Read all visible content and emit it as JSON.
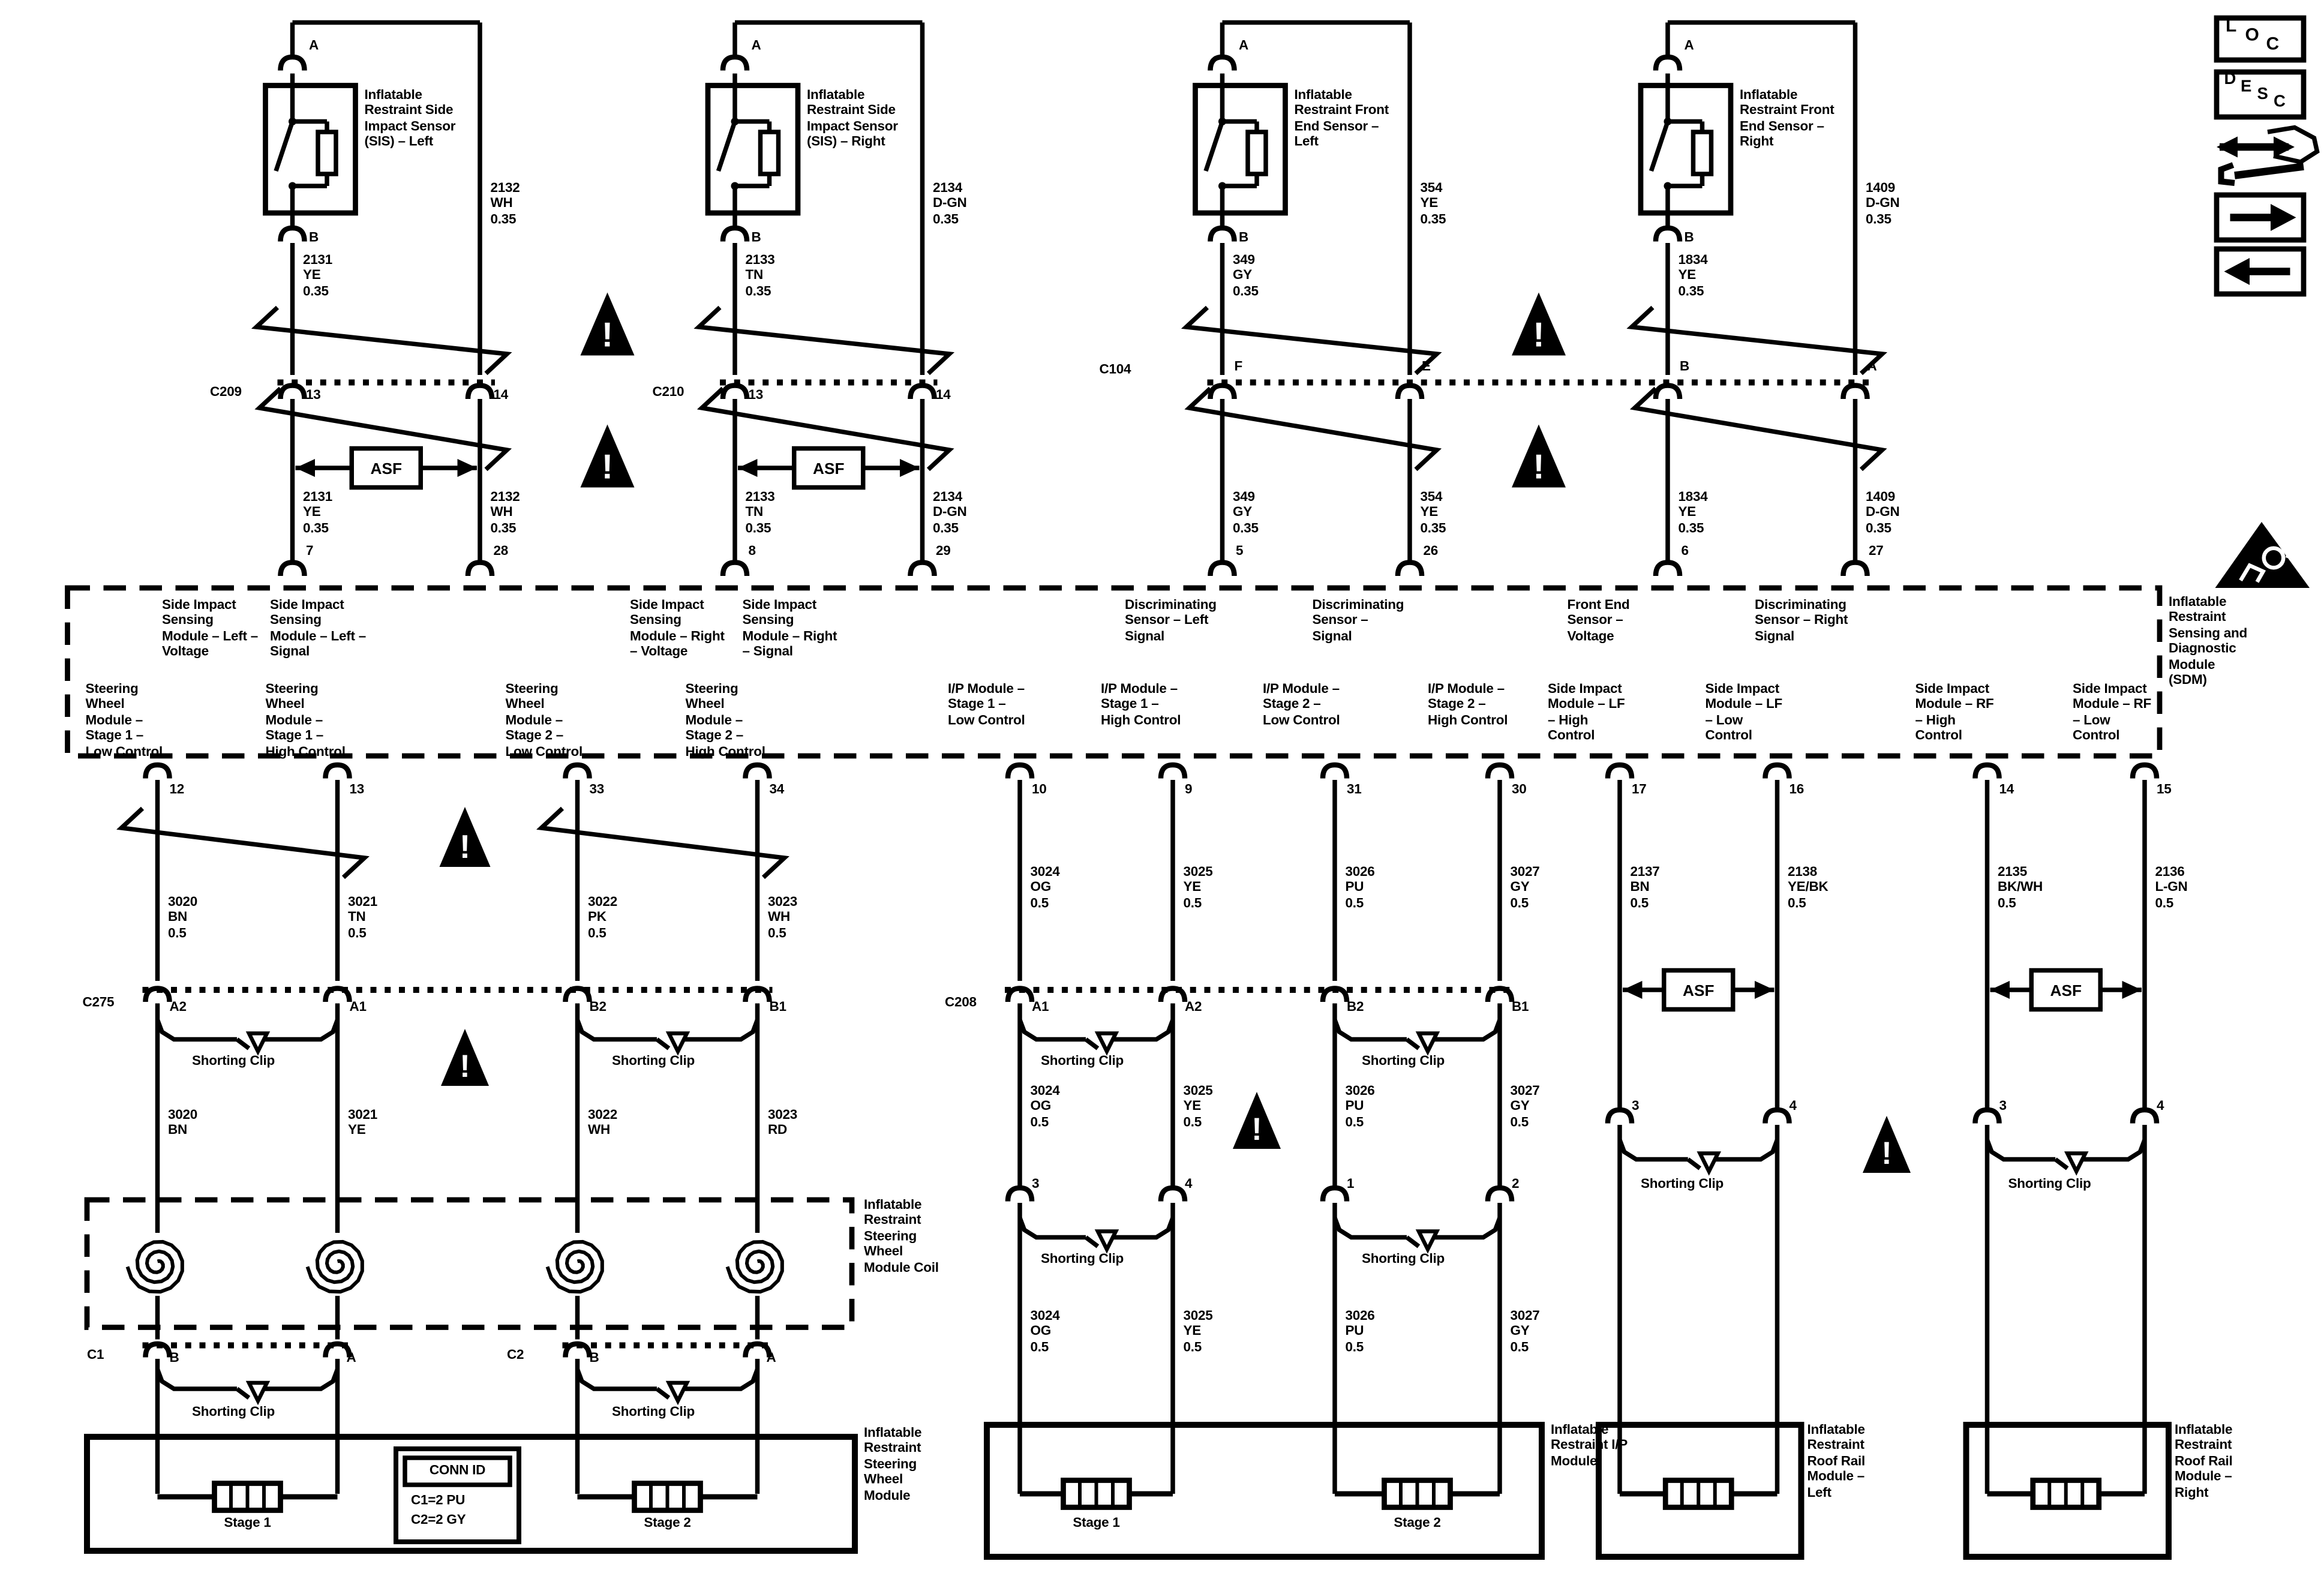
{
  "colors": {
    "ink": "#000000",
    "paper": "#ffffff"
  },
  "labels": {
    "shorting_clip": "Shorting Clip",
    "asf": "ASF",
    "warning_glyph": "!"
  },
  "legend": {
    "loc": "LOC",
    "desc": "DESC",
    "icons": [
      "loc-tag",
      "desc-tag",
      "wrench-direction",
      "arrow-right",
      "arrow-left",
      "sir-airbag-warning"
    ]
  },
  "sensor_circuits": [
    {
      "name": "Inflatable Restraint Side Impact Sensor (SIS) – Left",
      "top_pin": "A",
      "bottom_pin": "B",
      "left_wire": {
        "id": "2131",
        "color": "YE",
        "size": "0.35"
      },
      "right_wire": {
        "id": "2132",
        "color": "WH",
        "size": "0.35"
      },
      "connector": "C209",
      "conn_pin_left": "13",
      "conn_pin_right": "14",
      "sdm_pin_left": "7",
      "sdm_pin_right": "28"
    },
    {
      "name": "Inflatable Restraint Side Impact Sensor (SIS) – Right",
      "top_pin": "A",
      "bottom_pin": "B",
      "left_wire": {
        "id": "2133",
        "color": "TN",
        "size": "0.35"
      },
      "right_wire": {
        "id": "2134",
        "color": "D-GN",
        "size": "0.35"
      },
      "connector": "C210",
      "conn_pin_left": "13",
      "conn_pin_right": "14",
      "sdm_pin_left": "8",
      "sdm_pin_right": "29"
    },
    {
      "name": "Inflatable Restraint Front End Sensor – Left",
      "top_pin": "A",
      "bottom_pin": "B",
      "left_wire": {
        "id": "349",
        "color": "GY",
        "size": "0.35"
      },
      "right_wire": {
        "id": "354",
        "color": "YE",
        "size": "0.35"
      },
      "connector": "C104",
      "conn_pin_left": "F",
      "conn_pin_right": "E",
      "sdm_pin_left": "5",
      "sdm_pin_right": "26"
    },
    {
      "name": "Inflatable Restraint Front End Sensor – Right",
      "top_pin": "A",
      "bottom_pin": "B",
      "left_wire": {
        "id": "1834",
        "color": "YE",
        "size": "0.35"
      },
      "right_wire": {
        "id": "1409",
        "color": "D-GN",
        "size": "0.35"
      },
      "connector": "",
      "conn_pin_left": "B",
      "conn_pin_right": "A",
      "sdm_pin_left": "6",
      "sdm_pin_right": "27"
    }
  ],
  "sdm": {
    "module_label": "Inflatable Restraint Sensing and Diagnostic Module (SDM)",
    "top_functions": [
      "Side Impact Sensing Module – Left – Voltage",
      "Side Impact Sensing Module – Left – Signal",
      "Side Impact Sensing Module – Right – Voltage",
      "Side Impact Sensing Module – Right – Signal",
      "Discriminating Sensor – Left Signal",
      "Discriminating Sensor – Signal",
      "Front End Sensor – Voltage",
      "Discriminating Sensor – Right Signal"
    ],
    "bottom_functions": [
      "Steering Wheel Module – Stage 1 – Low Control",
      "Steering Wheel Module – Stage 1 – High Control",
      "Steering Wheel Module – Stage 2 – Low Control",
      "Steering Wheel Module – Stage 2 – High Control",
      "I/P Module – Stage 1 – Low Control",
      "I/P Module – Stage 1 – High Control",
      "I/P Module – Stage 2 – Low Control",
      "I/P Module – Stage 2 – High Control",
      "Side Impact Module – LF – High Control",
      "Side Impact Module – LF – Low Control",
      "Side Impact Module – RF – High Control",
      "Side Impact Module – RF – Low Control"
    ],
    "bottom_pins": [
      "12",
      "13",
      "33",
      "34",
      "10",
      "9",
      "31",
      "30",
      "17",
      "16",
      "14",
      "15"
    ]
  },
  "steering": {
    "upper_wires": [
      {
        "id": "3020",
        "color": "BN",
        "size": "0.5"
      },
      {
        "id": "3021",
        "color": "TN",
        "size": "0.5"
      },
      {
        "id": "3022",
        "color": "PK",
        "size": "0.5"
      },
      {
        "id": "3023",
        "color": "WH",
        "size": "0.5"
      }
    ],
    "connector": "C275",
    "conn_pins": [
      "A2",
      "A1",
      "B2",
      "B1"
    ],
    "lower_wires": [
      {
        "id": "3020",
        "color": "BN"
      },
      {
        "id": "3021",
        "color": "YE"
      },
      {
        "id": "3022",
        "color": "WH"
      },
      {
        "id": "3023",
        "color": "RD"
      }
    ],
    "coil_label": "Inflatable Restraint Steering Wheel Module Coil",
    "stage_connectors": [
      {
        "name": "C1",
        "pins": [
          "B",
          "A"
        ]
      },
      {
        "name": "C2",
        "pins": [
          "B",
          "A"
        ]
      }
    ],
    "module_label": "Inflatable Restraint Steering Wheel Module",
    "stages": [
      "Stage 1",
      "Stage 2"
    ],
    "conn_id": {
      "title": "CONN ID",
      "rows": [
        "C1=2 PU",
        "C2=2 GY"
      ]
    }
  },
  "ip_module": {
    "wires": [
      {
        "id": "3024",
        "color": "OG",
        "size": "0.5"
      },
      {
        "id": "3025",
        "color": "YE",
        "size": "0.5"
      },
      {
        "id": "3026",
        "color": "PU",
        "size": "0.5"
      },
      {
        "id": "3027",
        "color": "GY",
        "size": "0.5"
      }
    ],
    "connector": "C208",
    "conn_pins": [
      "A1",
      "A2",
      "B2",
      "B1"
    ],
    "stage_pins": [
      "3",
      "4",
      "1",
      "2"
    ],
    "module_label": "Inflatable Restraint I/P Module",
    "stages": [
      "Stage 1",
      "Stage 2"
    ]
  },
  "roof_rail": {
    "wires": [
      {
        "id": "2137",
        "color": "BN",
        "size": "0.5"
      },
      {
        "id": "2138",
        "color": "YE/BK",
        "size": "0.5"
      },
      {
        "id": "2135",
        "color": "BK/WH",
        "size": "0.5"
      },
      {
        "id": "2136",
        "color": "L-GN",
        "size": "0.5"
      }
    ],
    "pins": [
      "3",
      "4",
      "3",
      "4"
    ],
    "module_left_label": "Inflatable Restraint Roof Rail Module – Left",
    "module_right_label": "Inflatable Restraint Roof Rail Module – Right"
  }
}
